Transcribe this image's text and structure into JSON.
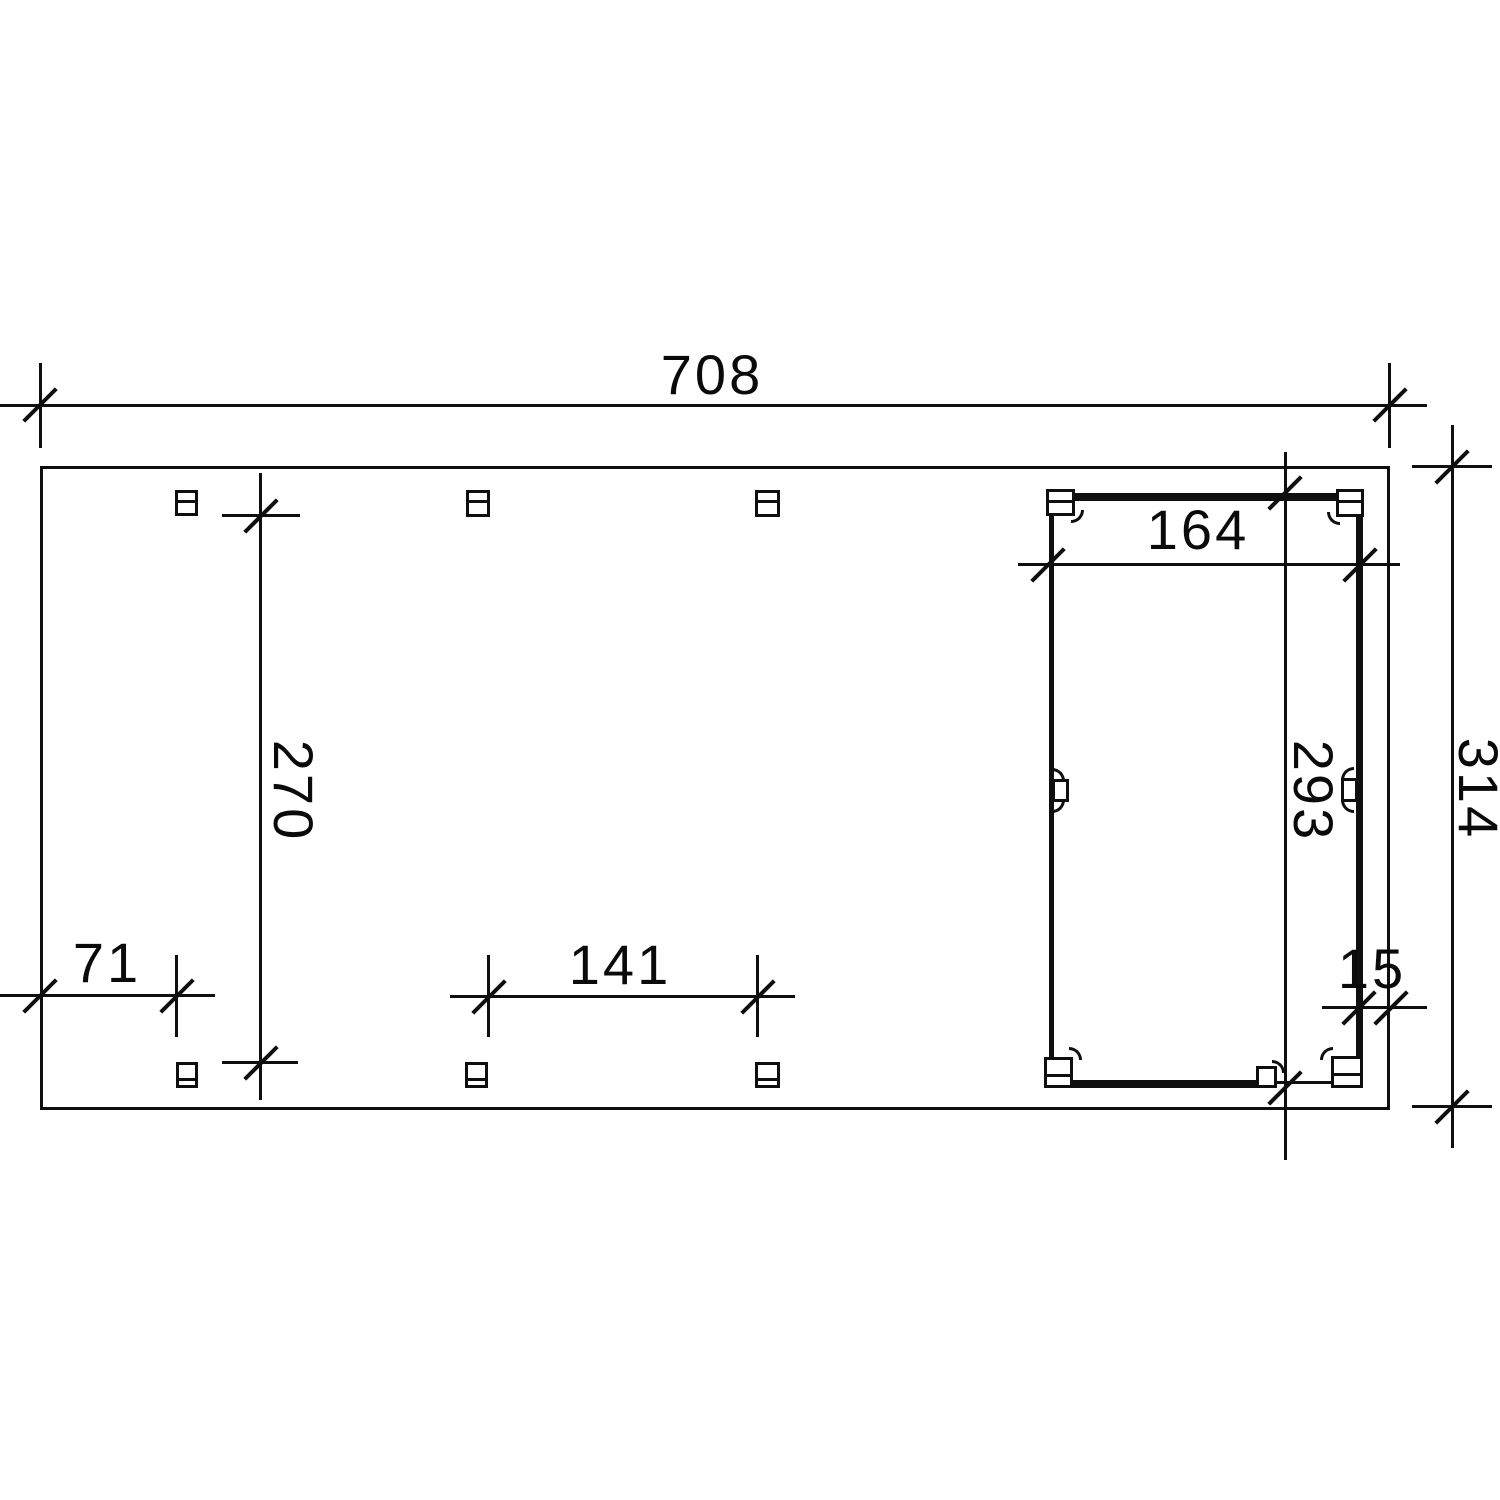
{
  "drawing": {
    "kind": "carport-floor-plan",
    "background": "#ffffff",
    "line_color": "#0f0f0f",
    "labels": {
      "total_width": "708",
      "room_width": "164",
      "clear_depth": "270",
      "room_depth": "293",
      "total_depth": "314",
      "left_offset": "71",
      "mid_spacing": "141",
      "right_offset": "15"
    }
  }
}
